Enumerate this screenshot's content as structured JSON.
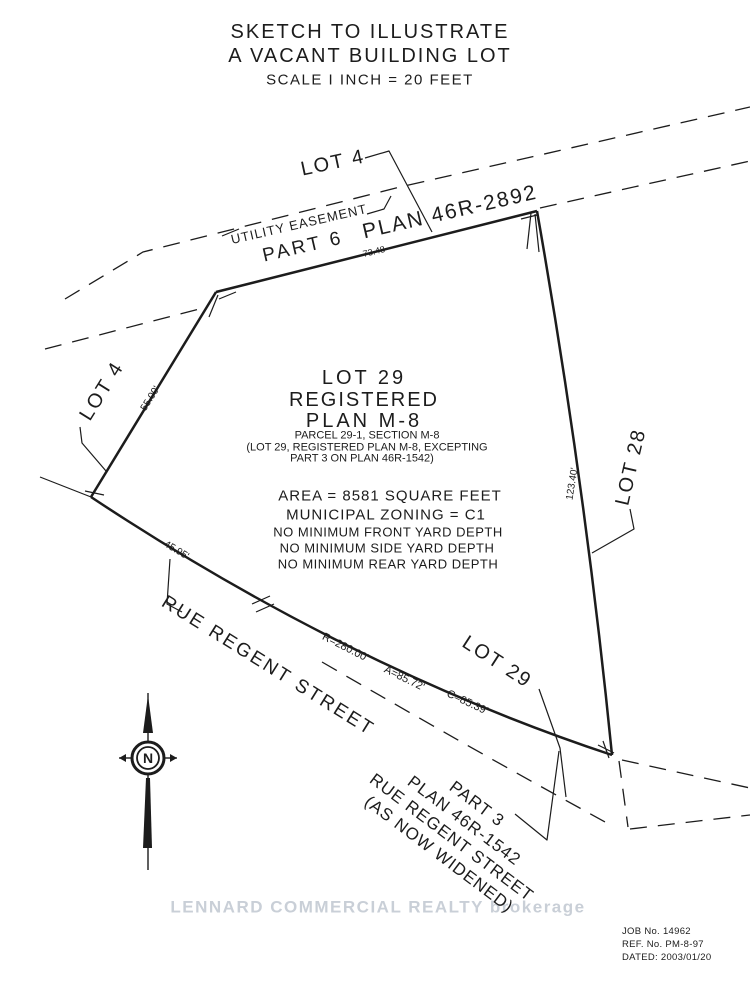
{
  "title": {
    "line1": "SKETCH TO ILLUSTRATE",
    "line2": "A VACANT BUILDING LOT",
    "line3": "SCALE I INCH = 20 FEET"
  },
  "parcel": {
    "name1": "LOT 29",
    "name2": "REGISTERED",
    "name3": "PLAN M-8",
    "sub1": "PARCEL 29-1, SECTION M-8",
    "sub2": "(LOT 29, REGISTERED PLAN M-8, EXCEPTING",
    "sub3": "PART 3 ON PLAN 46R-1542)",
    "area": "AREA = 8581 SQUARE FEET",
    "zoning": "MUNICIPAL ZONING = C1",
    "note1": "NO MINIMUM FRONT YARD DEPTH",
    "note2": "NO MINIMUM SIDE YARD DEPTH",
    "note3": "NO MINIMUM REAR YARD DEPTH"
  },
  "labels": {
    "lot4_top": "LOT 4",
    "lot4_left": "LOT 4",
    "lot28": "LOT 28",
    "lot29_curve": "LOT 29",
    "utility_easement": "UTILITY EASEMENT",
    "part6": "PART 6",
    "plan_46r_2892": "PLAN 46R-2892",
    "rue_regent_street": "RUE REGENT STREET",
    "widening_line1": "PART 3",
    "widening_line2": "PLAN 46R-1542",
    "widening_line3": "RUE REGENT STREET",
    "widening_line4": "(AS NOW WIDENED)",
    "north": "N"
  },
  "dimensions": {
    "top_edge": "73.48",
    "left_edge": "55.00'",
    "right_edge": "123.40'",
    "curve_start": "45.95'",
    "radius": "R=280.00'",
    "arc": "A=85.72'",
    "chord": "C=85.39'"
  },
  "watermark": "LENNARD COMMERCIAL REALTY  brokerage",
  "titleblock": {
    "job": "JOB No. 14962",
    "ref": "REF. No. PM-8-97",
    "dated": "DATED: 2003/01/20"
  },
  "colors": {
    "ink": "#1c1c1c",
    "watermark": "#c9cfd7",
    "background": "#ffffff"
  }
}
